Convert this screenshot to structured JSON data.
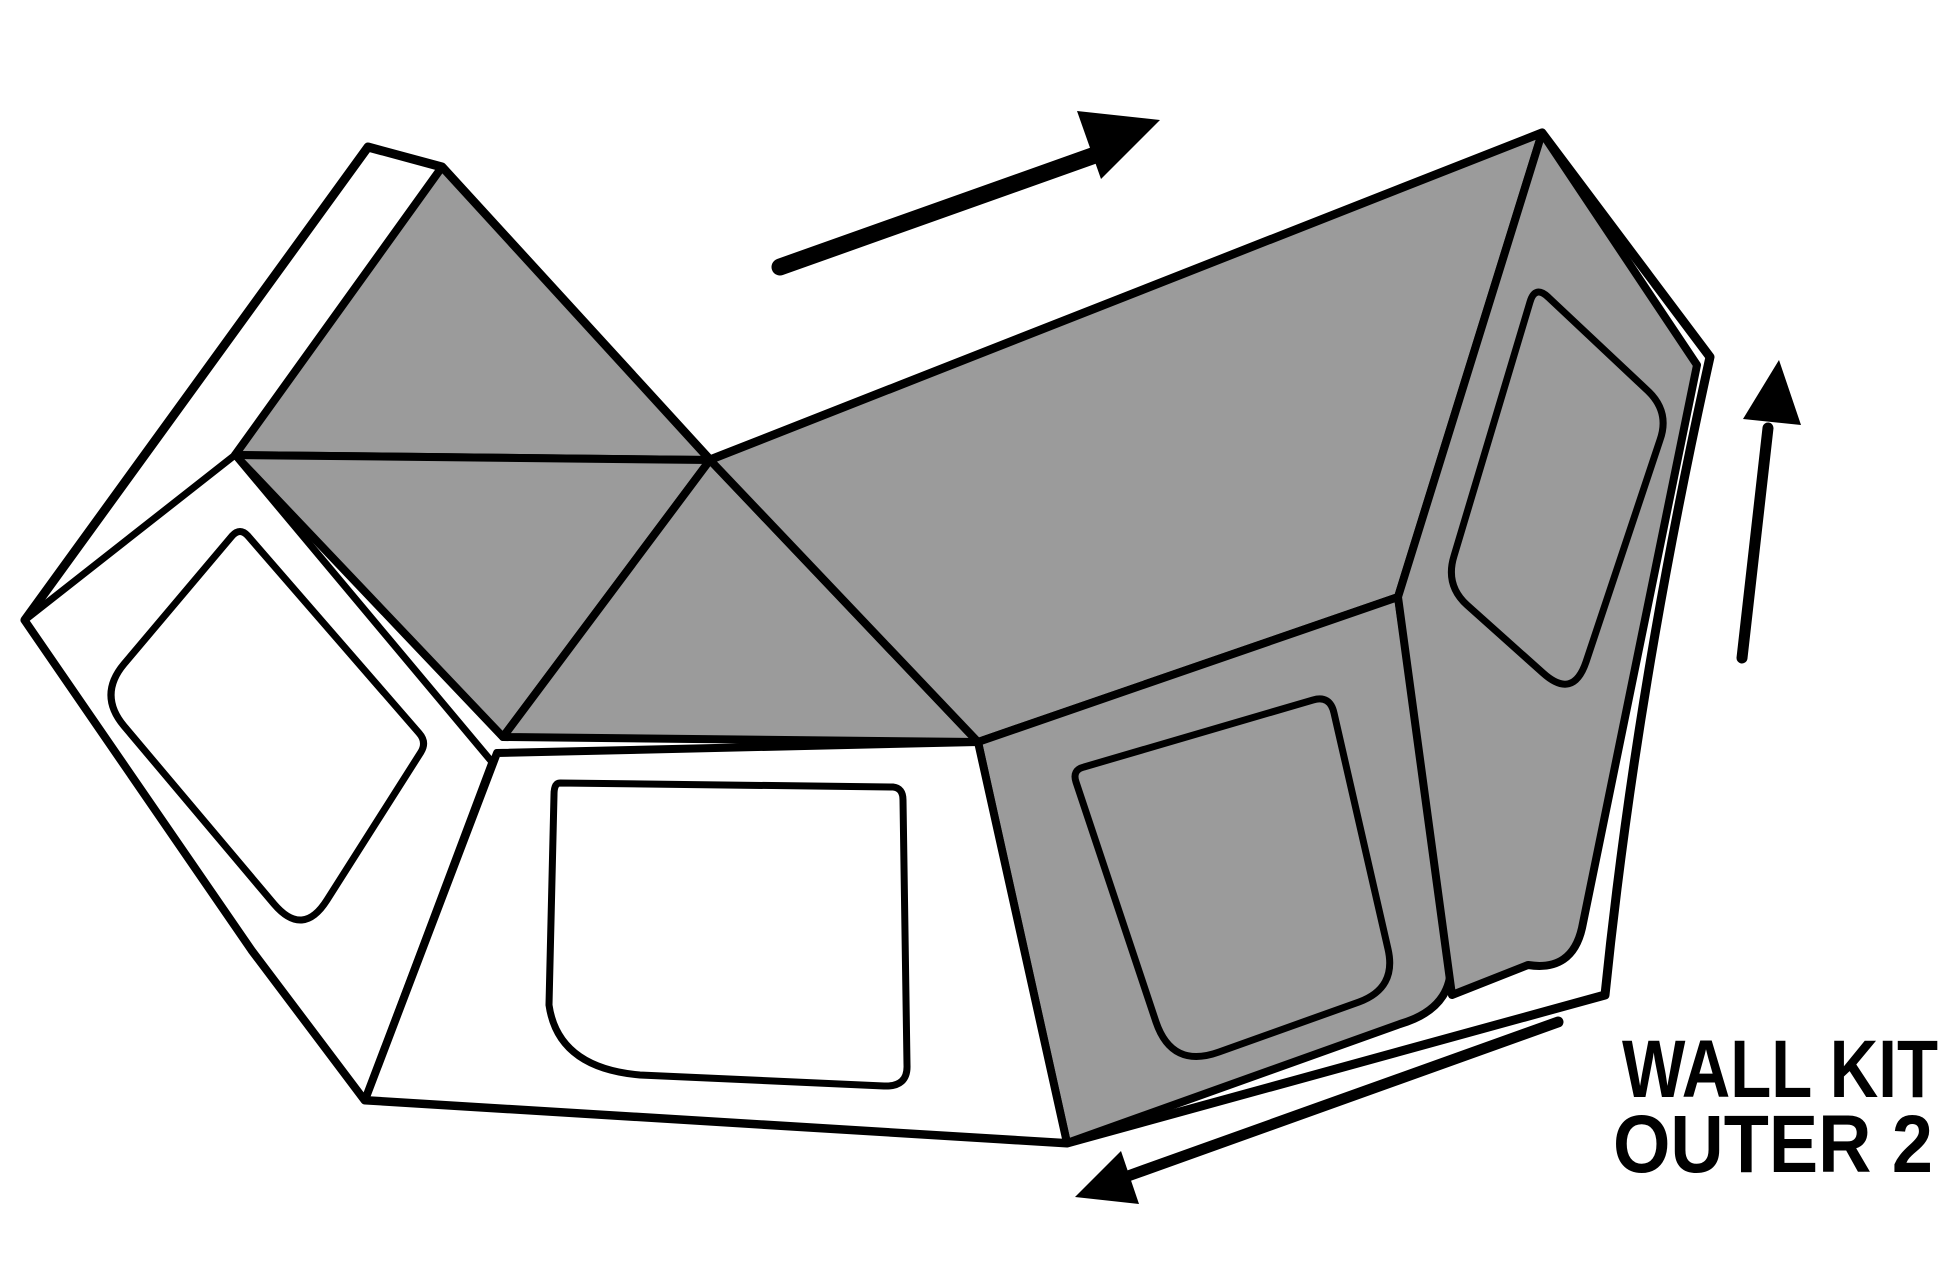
{
  "diagram": {
    "canvas": {
      "w": 1946,
      "h": 1264,
      "bg": "#ffffff"
    },
    "colors": {
      "gray": "#9b9b9b",
      "white": "#ffffff",
      "black": "#000000"
    },
    "label": {
      "line1": "WALL KIT",
      "line2": "OUTER 2"
    },
    "label_layout": {
      "x1": 1622,
      "y1": 1097,
      "len1": 316,
      "x2": 1613,
      "y2": 1172,
      "len2": 320,
      "font_size": 82,
      "font_weight": "bold"
    },
    "shapes": [
      {
        "name": "outer-silhouette",
        "d": "M 368 147 L 442 167 L 710 460 L 1542 133 L 1710 357 Q 1636 690 1605 995 L 1067 1143 L 365 1100 L 252 950 L 25 620 Z",
        "fill": "white",
        "sw": 9
      },
      {
        "name": "roof-panel-left",
        "d": "M 442 167 L 710 460 L 235 455 Z",
        "fill": "gray",
        "sw": 8
      },
      {
        "name": "roof-panel-mid-left",
        "d": "M 235 455 L 710 460 L 503 737 Z",
        "fill": "gray",
        "sw": 8
      },
      {
        "name": "roof-panel-mid",
        "d": "M 710 460 L 978 742 L 503 737 Z",
        "fill": "gray",
        "sw": 8
      },
      {
        "name": "roof-panel-right",
        "d": "M 710 460 L 1542 133 L 1398 597 L 978 742 Z",
        "fill": "gray",
        "sw": 8
      },
      {
        "name": "side-wall-panel",
        "d": "M 978 742 L 1398 597 L 1449 948 Q 1461 1006 1400 1024 L 1067 1143 Z",
        "fill": "gray",
        "sw": 8
      },
      {
        "name": "end-cap-panel",
        "d": "M 1542 133 L 1697 365 L 1582 928 Q 1572 972 1528 965 L 1452 995 L 1398 597 Z",
        "fill": "gray",
        "sw": 8
      },
      {
        "name": "left-wall-panel",
        "d": "M 235 455 L 492 762 L 365 1100 L 252 950 L 25 620 Z",
        "fill": "white",
        "sw": 7
      },
      {
        "name": "front-wall-panel",
        "d": "M 497 753 L 978 742 L 1067 1143 L 365 1100 Z",
        "fill": "white",
        "sw": 8
      },
      {
        "name": "left-wall-window",
        "d": "M 248 536 L 419 733 Q 427 742 421 752 L 327 900 Q 303 938 274 904 L 124 726 Q 98 695 124 664 L 232 536 Q 240 527 248 536 Z",
        "fill": "none",
        "sw": 7
      },
      {
        "name": "front-wall-window",
        "d": "M 560 783 L 893 787 Q 903 788 903 800 L 907 1065 Q 908 1087 884 1086 L 640 1075 Q 558 1068 549 1005 L 554 795 Q 554 783 560 783 Z",
        "fill": "none",
        "sw": 7
      },
      {
        "name": "side-wall-window",
        "d": "M 1084 767 L 1313 700 Q 1330 695 1334 713 L 1388 949 Q 1397 988 1359 1002 L 1219 1052 Q 1172 1069 1156 1022 L 1076 782 Q 1072 770 1084 767 Z",
        "fill": "none",
        "sw": 7
      },
      {
        "name": "end-cap-window",
        "d": "M 1548 297 L 1648 391 Q 1670 412 1660 440 L 1586 662 Q 1573 700 1543 673 L 1467 605 Q 1445 585 1454 556 L 1530 302 Q 1535 285 1548 297 Z",
        "fill": "none",
        "sw": 7
      }
    ],
    "arrows": [
      {
        "name": "direction-arrow-top",
        "shaft": [
          780,
          267,
          1095,
          155
        ],
        "sw": 17,
        "head": [
          [
            1160,
            120
          ],
          [
            1101,
            179
          ],
          [
            1077,
            111
          ]
        ]
      },
      {
        "name": "direction-arrow-right",
        "shaft": [
          1742,
          658,
          1768,
          428
        ],
        "sw": 11,
        "head": [
          [
            1779,
            360
          ],
          [
            1801,
            425
          ],
          [
            1743,
            419
          ]
        ]
      },
      {
        "name": "direction-arrow-bottom",
        "shaft": [
          1558,
          1022,
          1128,
          1176
        ],
        "sw": 11,
        "head": [
          [
            1075,
            1197
          ],
          [
            1121,
            1151
          ],
          [
            1139,
            1204
          ]
        ]
      }
    ]
  }
}
